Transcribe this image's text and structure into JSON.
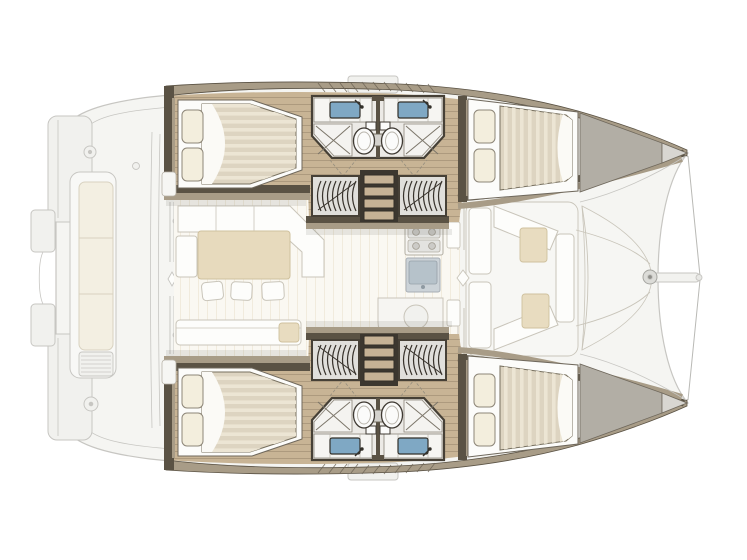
{
  "figure": {
    "type": "catamaran-floor-plan",
    "view": "top-down",
    "orientation": "bow-right",
    "hulls": 2,
    "cabins": 4,
    "bathrooms": 4
  },
  "colors": {
    "background": "#ffffff",
    "ghost_line": "#c7c6c2",
    "ghost_fill": "#f5f5f2",
    "deck_fill": "#f1f1ee",
    "cockpit_cushion": "#f3efe2",
    "upholstery_beige": "#e8dcc0",
    "table": "#e7dabd",
    "salon_floor": "#faf8f2",
    "salon_plank": "#f1ebdd",
    "wood_floor": "#c8b495",
    "wood_line": "#ab987c",
    "wall_dark": "#5a5244",
    "wall_tan": "#a89c87",
    "bed_frame": "#fcfcfa",
    "mattress": "#ddd4c1",
    "mattress_stripe": "#ece5d4",
    "sheet_white": "#fbfaf6",
    "pillow": "#f3eedd",
    "bath_floor": "#eceae6",
    "counter": "#f6f5f2",
    "fixture_white": "#fbfbfa",
    "sink_blue": "#7fa8c4",
    "steel_gray": "#ccd3d8",
    "steel_dark": "#b6c2ca",
    "wardrobe_floor": "#e0dfdb",
    "dark_detail": "#3c372f",
    "step_tread": "#c6b295",
    "wedge": "#b2aea5",
    "wedge_tip": "#d8d6d1",
    "white": "#fdfdfb"
  },
  "fixtures": {
    "double_berth": "double-berth",
    "pillow": "pillow",
    "toilet": "toilet",
    "washbasin": "washbasin",
    "shower": "shower",
    "hanging_locker": "hanging-locker-coil",
    "companionway": "companionway-steps",
    "stove": "stove-burners",
    "galley_sink": "galley-sink",
    "dining_table": "dining-table",
    "stool": "stool",
    "sofa": "l-sofa",
    "bench": "bench-seat",
    "windlass": "windlass",
    "bowsprit": "bowsprit",
    "bridle": "bow-bridle-lines",
    "swim_platform": "swim-platform"
  }
}
